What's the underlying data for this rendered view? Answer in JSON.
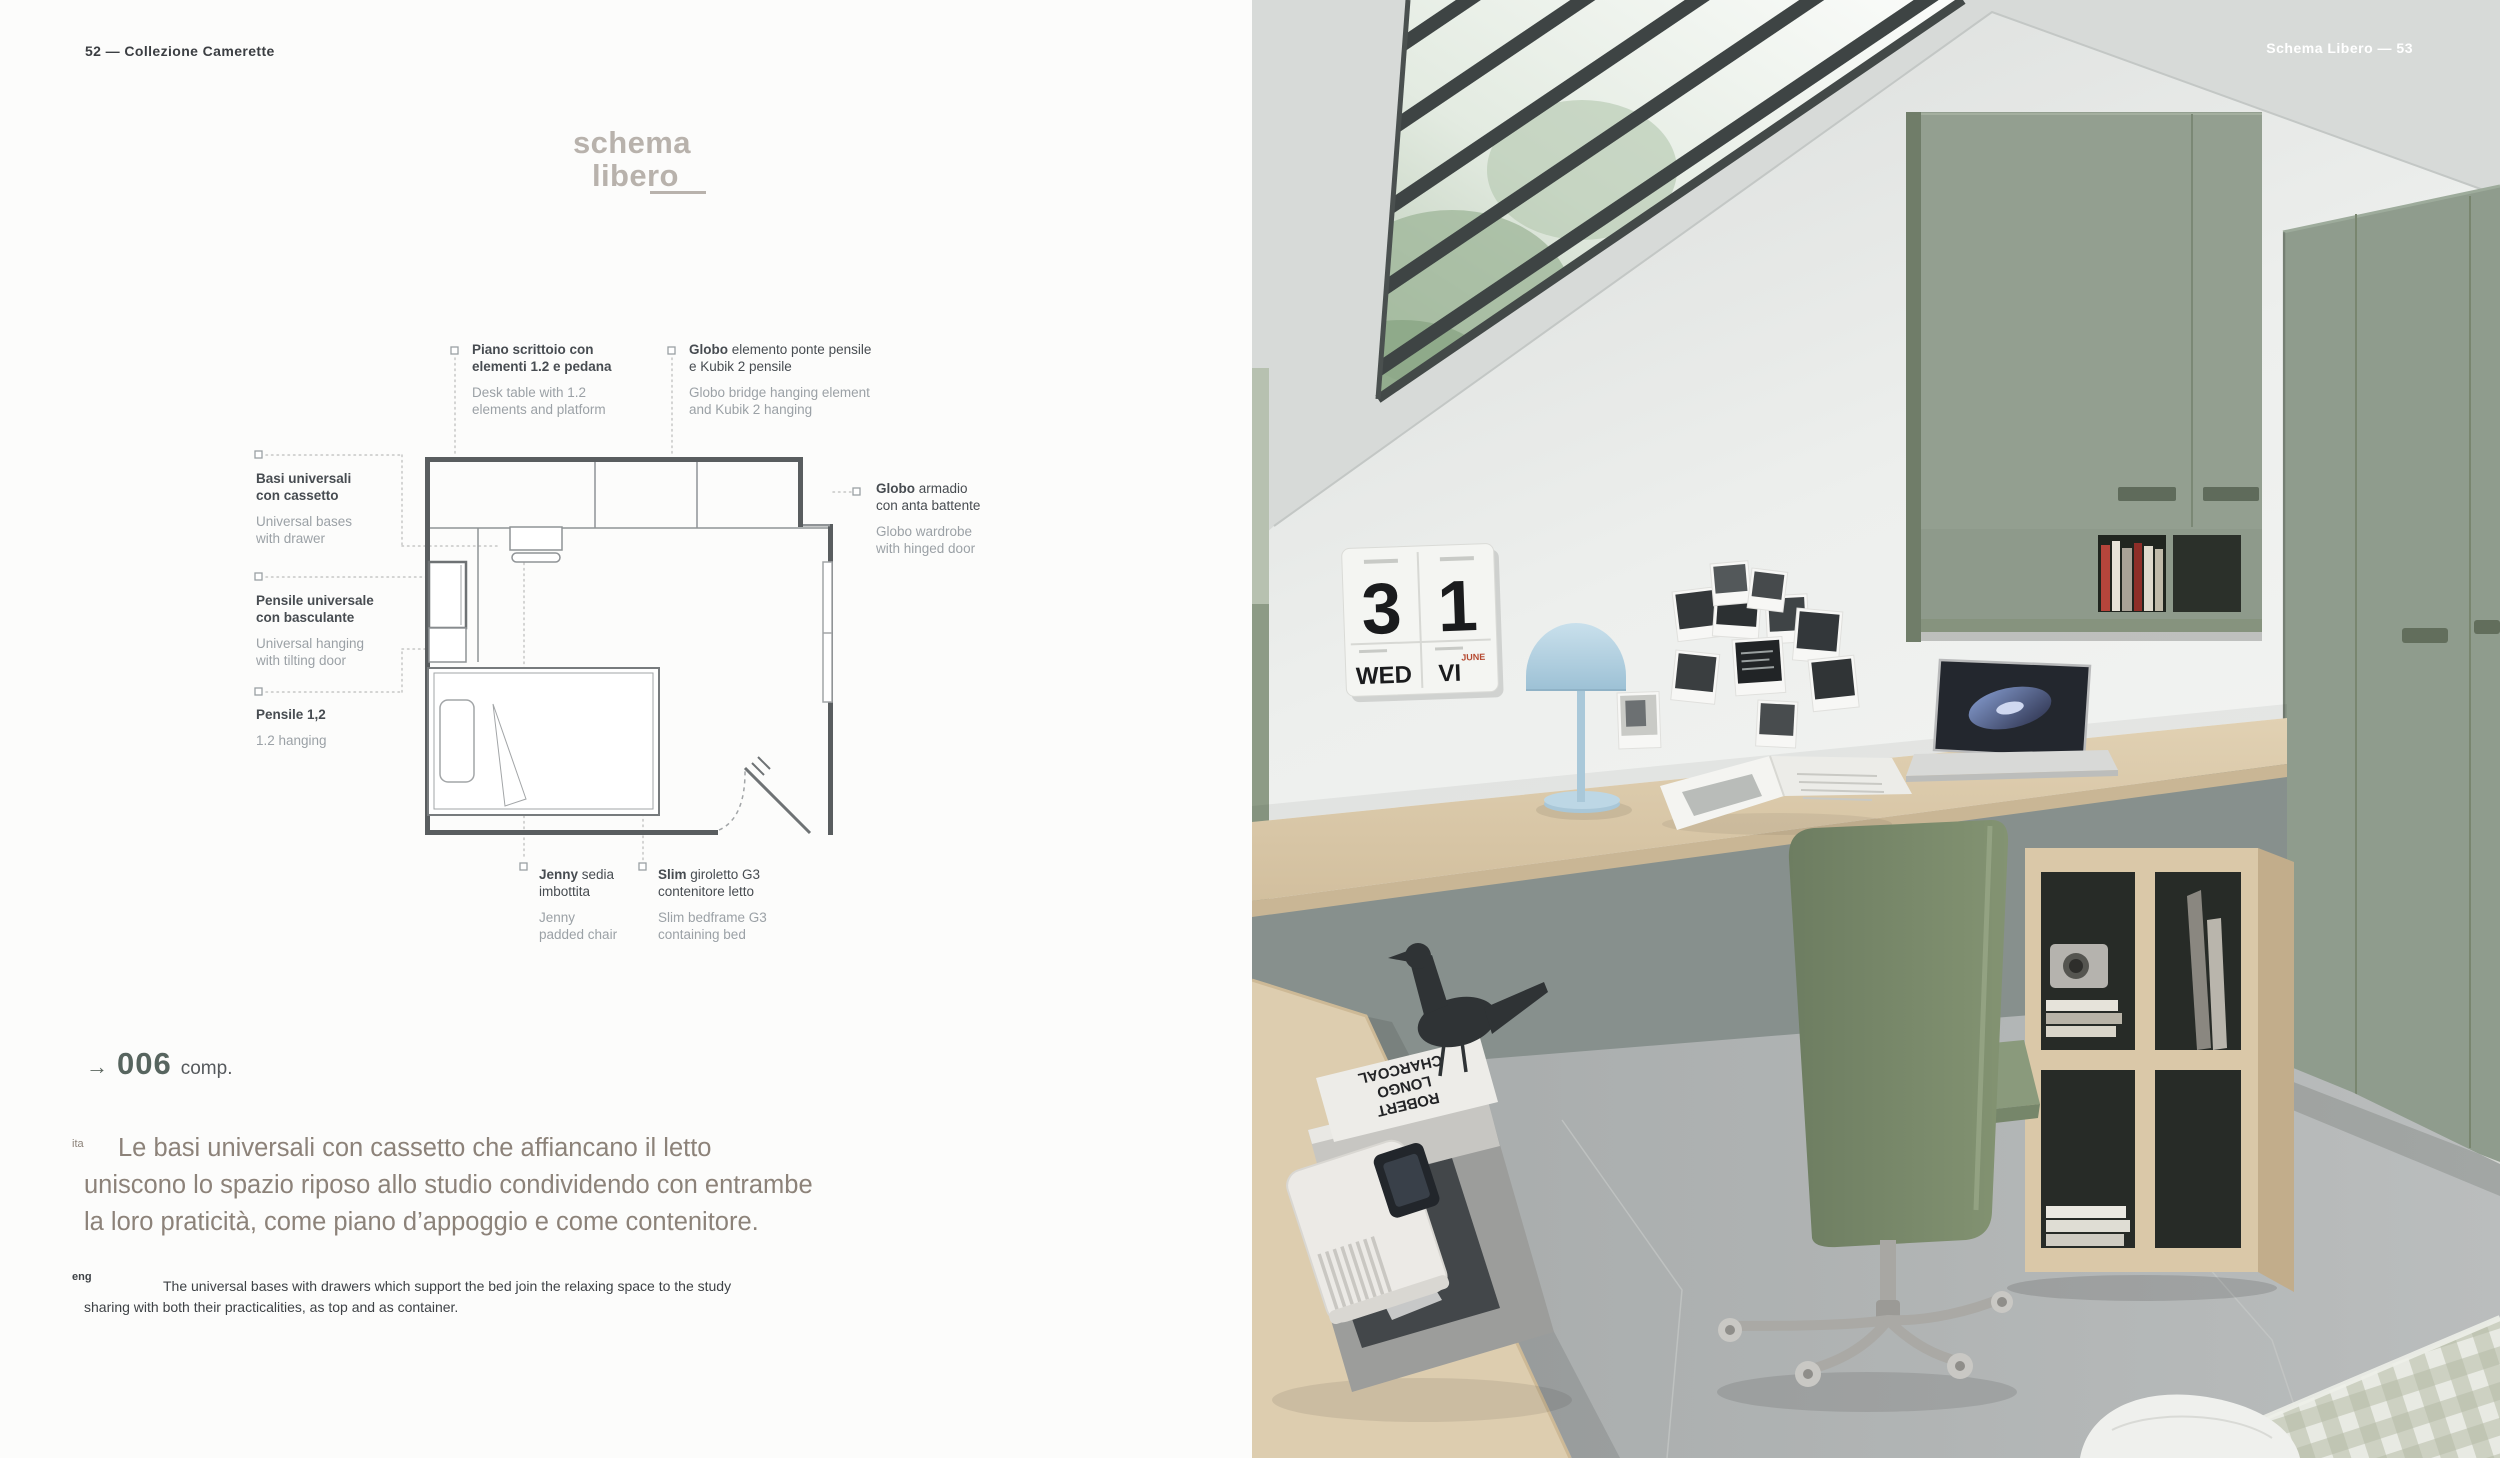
{
  "palette": {
    "cabinet_green": "#909c8e",
    "cabinet_green_dark": "#6f7c69",
    "desk_wood": "#dccbad",
    "floor_gray": "#aeb1b1",
    "wall_light": "#f2f3f1",
    "ceiling_gray": "#d7dad8",
    "lamp_blue": "#b6d3e2",
    "chair_green": "#78886c",
    "title_gray": "#b8b2ac",
    "comp_green": "#57655f",
    "text_dark": "#44484d",
    "text_gray": "#9ba1a6",
    "ita_text": "#8c8279",
    "calendar_red": "#b5482f"
  },
  "left_page": {
    "header": "52 — Collezione Camerette",
    "title": {
      "line1": "schema",
      "line2": "libero"
    },
    "plan_labels": [
      {
        "lead": "",
        "ita": "Piano scrittoio con\nelementi 1.2 e pedana",
        "eng": "Desk table with 1.2\nelements and platform"
      },
      {
        "lead": "Globo",
        "ita": " elemento ponte pensile\ne Kubik 2 pensile",
        "eng": "Globo bridge hanging element\nand Kubik 2 hanging"
      },
      {
        "lead": "",
        "ita": "Basi universali\ncon cassetto",
        "eng": "Universal bases\nwith drawer"
      },
      {
        "lead": "",
        "ita": "Pensile universale\ncon basculante",
        "eng": "Universal hanging\nwith tilting door"
      },
      {
        "lead": "",
        "ita": "Pensile 1,2",
        "eng": "1.2 hanging"
      },
      {
        "lead": "Globo",
        "ita": " armadio\ncon anta battente",
        "eng": "Globo wardrobe\nwith hinged door"
      },
      {
        "lead": "Jenny",
        "ita": " sedia\nimbottita",
        "eng": "Jenny\npadded chair"
      },
      {
        "lead": "Slim",
        "ita": " giroletto G3\ncontenitore letto",
        "eng": "Slim bedframe G3\ncontaining bed"
      }
    ],
    "composition": {
      "arrow": "→",
      "number": "006",
      "suffix": "comp."
    },
    "ita_tag": "ita",
    "ita_paragraph": "Le basi universali con cassetto che affiancano il letto\nuniscono lo spazio riposo allo studio condividendo con entrambe\nla loro praticità, come piano d’appoggio e come contenitore.",
    "eng_tag": "eng",
    "eng_paragraph": "The universal bases with drawers which support the bed join the relaxing space to the study\nsharing with both their practicalities, as top and as container."
  },
  "photo": {
    "header": "Schema Libero — 53",
    "calendar": {
      "digit1": "3",
      "digit2": "1",
      "weekday": "WED",
      "month": "VI",
      "month_label": "JUNE"
    },
    "book_spine": [
      "ROBERT",
      "LONGO",
      "CHARCOAL"
    ]
  }
}
